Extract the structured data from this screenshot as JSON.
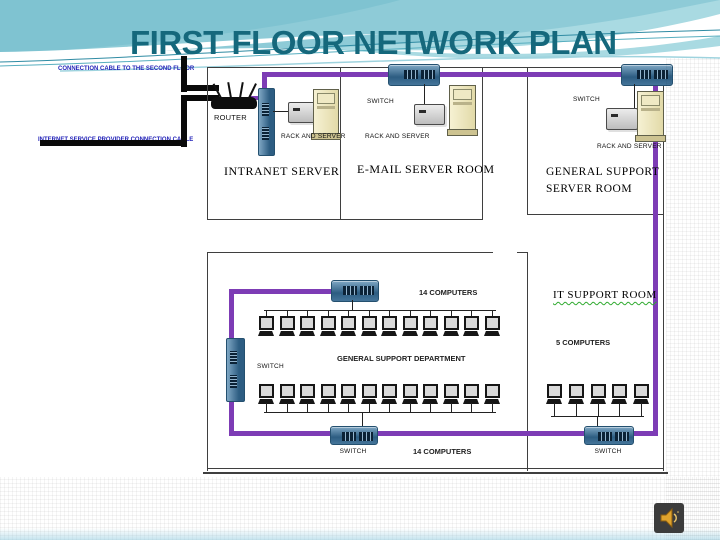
{
  "slide": {
    "title": "FIRST FLOOR NETWORK PLAN"
  },
  "cables": {
    "second_floor_label": "CONNECTION CABLE TO THE SECOND FLOOR",
    "isp_label": "INTERNET SERVICE PROVIDER CONNECTION CABLE",
    "trunk_color": "#7d3cb5",
    "building_cable_color": "#0a0a0a"
  },
  "rooms": {
    "intranet_server": {
      "name": "INTRANET SERVER",
      "router_label": "ROUTER",
      "rack_label": "RACK  AND SERVER"
    },
    "email_server": {
      "name": "E-MAIL  SERVER ROOM",
      "switch_label": "SWITCH",
      "rack_label": "RACK AND SERVER"
    },
    "general_support_server": {
      "name_line1": "GENERAL SUPPORT",
      "name_line2": "SERVER ROOM",
      "switch_label": "SWITCH",
      "rack_label": "RACK AND SERVER"
    },
    "general_support_department": {
      "name": "GENERAL SUPPORT DEPARTMENT",
      "top_count_label": "14 COMPUTERS",
      "bottom_count_label": "14 COMPUTERS",
      "left_switch_label": "SWITCH",
      "bottom_switch_label": "SWITCH",
      "row1_icon_count": 12,
      "row2_icon_count": 12
    },
    "it_support": {
      "name": "IT SUPPORT ROOM",
      "count_label": "5 COMPUTERS",
      "switch_label": "SWITCH",
      "icon_count": 5
    }
  },
  "icons": {
    "speaker": "audio-speaker",
    "speaker_color": "#dfa32d"
  },
  "theme": {
    "title_color": "#15687c",
    "wave_teal_light": "#9ad3dd",
    "wave_teal_medium": "#7fc3d1",
    "label_blue": "#2323b8"
  }
}
